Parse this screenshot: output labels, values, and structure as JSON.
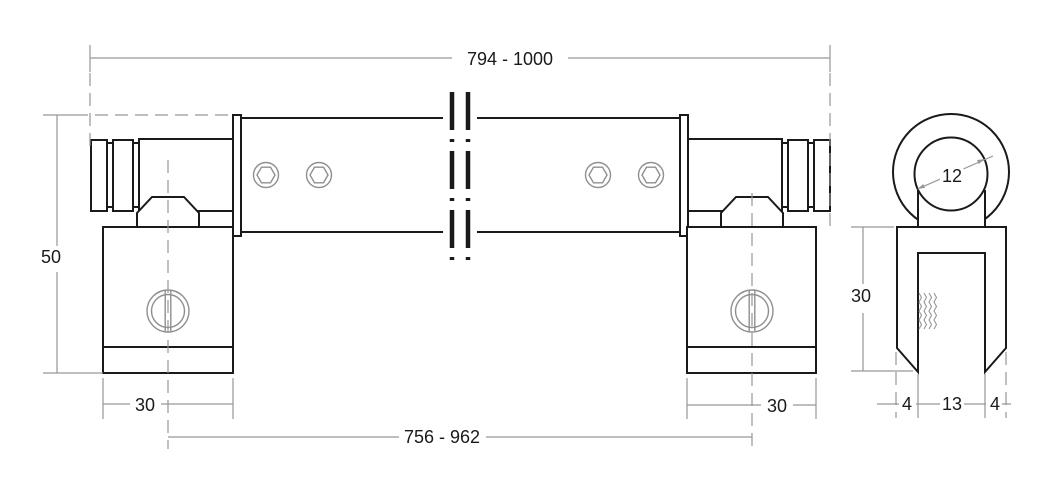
{
  "colors": {
    "outline": "#1a1a1a",
    "detail": "#8f8f8f",
    "dimension": "#979797",
    "text": "#1a1a1a",
    "background": "#ffffff"
  },
  "views": {
    "front_view": "front-elevation-of-stabilizer-bar",
    "side_view": "side-profile-of-glass-clamp"
  },
  "dims": {
    "overall_length": "794 - 1000",
    "total_height": "50",
    "left_clamp_width": "30",
    "right_clamp_width": "30",
    "center_distance": "756 - 962",
    "ring_inner_diameter": "12",
    "side_clamp_height": "30",
    "side_left_wall": "4",
    "side_slot_width": "13",
    "side_right_wall": "4"
  }
}
